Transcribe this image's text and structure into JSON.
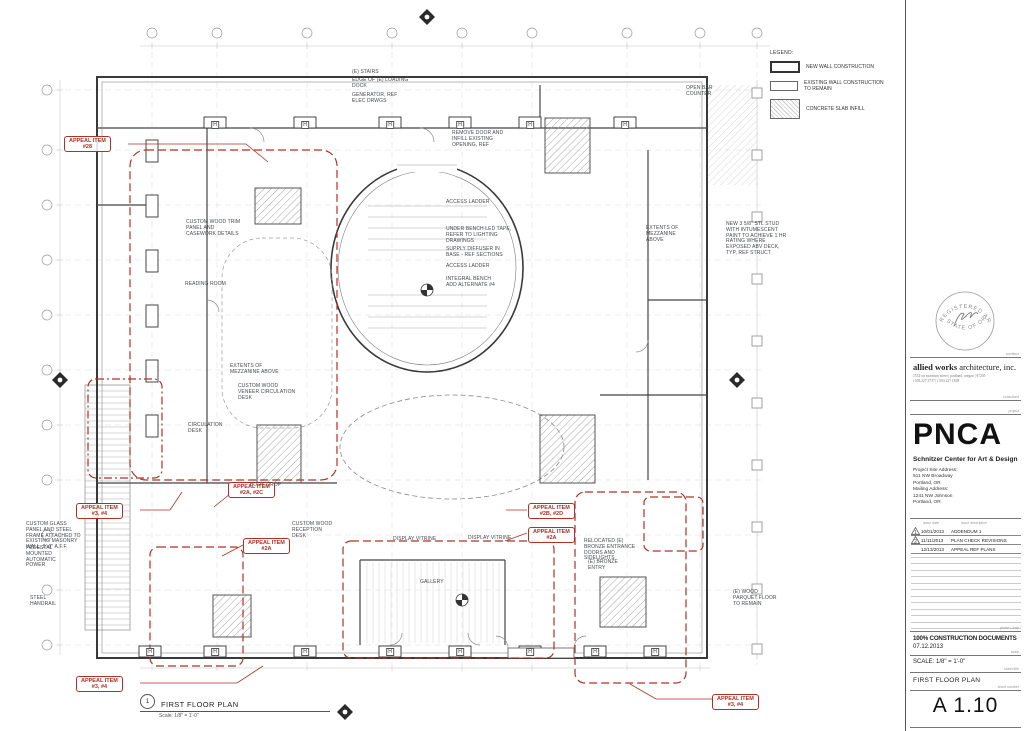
{
  "titleblock": {
    "stamp": {
      "arc_top": "REGISTERED ARCHITECT",
      "arc_bottom": "STATE OF OREGON"
    },
    "firm": {
      "name_bold": "allied works",
      "name_rest": " architecture, inc.",
      "address": "1532 sw morrison street | portland, oregon | 97205",
      "phone": "t 503.227.1737 | f 503.227.1828"
    },
    "client_logo": "PNCA",
    "project_title": "Schnitzer Center for Art & Design",
    "project_lines": "Project Site Address:\n511 NW Broadway\nPortland, OR\nMailing Address:\n1241 NW Johnson\nPortland, OR",
    "micro_labels": {
      "architect": "architect",
      "consultant": "consultant",
      "project": "project",
      "issue_date": "issue date",
      "issue_desc": "issue description",
      "phase": "phase / date",
      "scale": "scale",
      "sheet_title": "sheet title",
      "sheet_number": "sheet number"
    },
    "revisions": [
      {
        "delta": "1",
        "date": "10/01/2013",
        "desc": "ADDENDUM 1"
      },
      {
        "delta": "2",
        "date": "11/11/2013",
        "desc": "PLAN CHECK REVISIONS"
      },
      {
        "delta": "",
        "date": "12/13/2013",
        "desc": "APPEAL REF PLANS"
      }
    ],
    "phase": "100% CONSTRUCTION DOCUMENTS",
    "date": "07.12.2013",
    "scale": "SCALE: 1/8\" = 1'-0\"",
    "sheet_title": "FIRST FLOOR PLAN",
    "sheet_number": "A 1.10"
  },
  "legend": {
    "title": "LEGEND:",
    "items": [
      {
        "swatch": "new-wall",
        "label": "NEW WALL CONSTRUCTION"
      },
      {
        "swatch": "existing-wall",
        "label": "EXISTING WALL CONSTRUCTION\nTO REMAIN"
      },
      {
        "swatch": "concrete-infill",
        "label": "CONCRETE SLAB INFILL"
      }
    ]
  },
  "drawing_title": {
    "number": "1",
    "name": "FIRST FLOOR PLAN",
    "scale": "Scale: 1/8\" = 1'-0\""
  },
  "plan": {
    "h_tag": "H",
    "accent_red": "#b03028",
    "appeal_items": [
      {
        "line1": "APPEAL ITEM",
        "line2": "#28",
        "x": 64,
        "y": 136
      },
      {
        "line1": "APPEAL ITEM",
        "line2": "#3, #4",
        "x": 76,
        "y": 503
      },
      {
        "line1": "APPEAL ITEM",
        "line2": "#2A, #2C",
        "x": 228,
        "y": 482
      },
      {
        "line1": "APPEAL ITEM",
        "line2": "#2A",
        "x": 243,
        "y": 538
      },
      {
        "line1": "APPEAL ITEM",
        "line2": "#2B, #2D",
        "x": 528,
        "y": 503
      },
      {
        "line1": "APPEAL ITEM",
        "line2": "#2A",
        "x": 528,
        "y": 527
      },
      {
        "line1": "APPEAL ITEM",
        "line2": "#3, #4",
        "x": 76,
        "y": 676
      },
      {
        "line1": "APPEAL ITEM",
        "line2": "#3, #4",
        "x": 712,
        "y": 694
      }
    ],
    "labels": [
      {
        "text": "(E) STAIRS",
        "x": 352,
        "y": 70
      },
      {
        "text": "EDGE OF (E) LOADING DOCK",
        "x": 352,
        "y": 78,
        "w": 60
      },
      {
        "text": "GENERATOR, REF ELEC DRWGS",
        "x": 352,
        "y": 93,
        "w": 58
      },
      {
        "text": "REMOVE DOOR AND INFILL EXISTING OPENING, REF",
        "x": 452,
        "y": 131,
        "w": 58
      },
      {
        "text": "OPEN BAR COUNTER",
        "x": 686,
        "y": 86,
        "w": 40
      },
      {
        "text": "ACCESS LADDER",
        "x": 446,
        "y": 200
      },
      {
        "text": "UNDER BENCH LED TAPE, REFER TO LIGHTING DRAWINGS",
        "x": 446,
        "y": 227,
        "w": 66
      },
      {
        "text": "SUPPLY DIFFUSER IN BASE - REF SECTIONS",
        "x": 446,
        "y": 247,
        "w": 58
      },
      {
        "text": "ACCESS LADDER",
        "x": 446,
        "y": 264
      },
      {
        "text": "INTEGRAL BENCH ADD ALTERNATE #4",
        "x": 446,
        "y": 277,
        "w": 52
      },
      {
        "text": "CUSTOM WOOD TRIM PANEL AND CASEWORK DETAILS",
        "x": 186,
        "y": 220,
        "w": 58
      },
      {
        "text": "READING ROOM",
        "x": 185,
        "y": 282
      },
      {
        "text": "EXTENTS OF MEZZANINE ABOVE",
        "x": 230,
        "y": 364,
        "w": 52
      },
      {
        "text": "CUSTOM WOOD VENEER CIRCULATION DESK",
        "x": 238,
        "y": 384,
        "w": 60
      },
      {
        "text": "CIRCULATION DESK",
        "x": 188,
        "y": 423,
        "w": 40
      },
      {
        "text": "EXTENTS OF MEZZANINE ABOVE",
        "x": 646,
        "y": 226,
        "w": 46
      },
      {
        "text": "NEW 3 5/8\" STL STUD WITH INTUMESCENT PAINT TO ACHIEVE 1 HR RATING WHERE EXPOSED ABV DECK, TYP, REF STRUCT",
        "x": 726,
        "y": 222,
        "w": 62
      },
      {
        "text": "BOOK DROP",
        "x": 250,
        "y": 483
      },
      {
        "text": "CUSTOM WOOD RECEPTION DESK",
        "x": 292,
        "y": 522,
        "w": 44
      },
      {
        "text": "RELOCATED (E) BRONZE ENTRANCE DOORS AND SIDELIGHTS",
        "x": 584,
        "y": 539,
        "w": 56
      },
      {
        "text": "DISPLAY VITRINE",
        "x": 393,
        "y": 537
      },
      {
        "text": "DISPLAY VITRINE",
        "x": 468,
        "y": 536
      },
      {
        "text": "GALLERY",
        "x": 420,
        "y": 580
      },
      {
        "text": "(E) BRONZE ENTRY",
        "x": 588,
        "y": 560,
        "w": 34
      },
      {
        "text": "(E) WOOD PARQUET FLOOR TO REMAIN",
        "x": 733,
        "y": 590,
        "w": 50
      },
      {
        "text": "CUSTOM GLASS PANEL AND STEEL FRAME ATTACHED TO EXISTING MASONRY WALL, 9'-0\" A.F.F.",
        "x": 26,
        "y": 522,
        "w": 58
      },
      {
        "text": "PEDESTAL MOUNTED AUTOMATIC POWER",
        "x": 26,
        "y": 546,
        "w": 48
      },
      {
        "text": "STEEL HANDRAIL",
        "x": 30,
        "y": 596,
        "w": 34
      }
    ]
  }
}
